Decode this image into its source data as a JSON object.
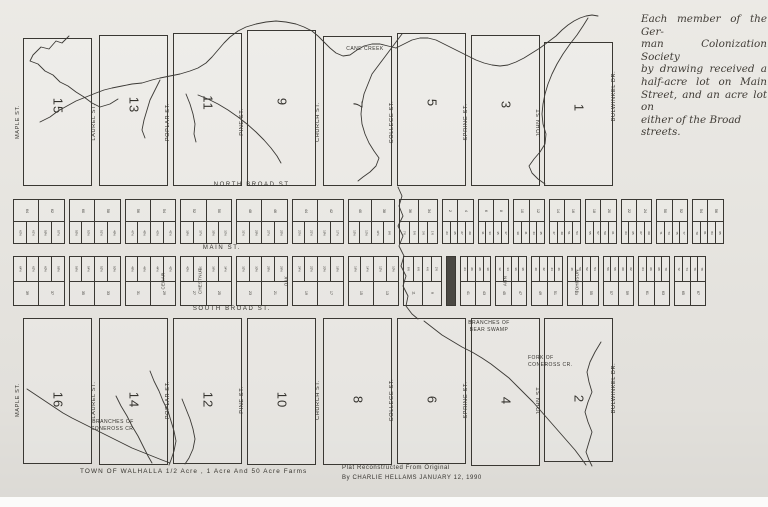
{
  "colors": {
    "paper": "#e9e7e2",
    "ink": "#35332e"
  },
  "streets": {
    "vertical": [
      "MAPLE ST.",
      "LAUREL ST.",
      "POPLAR ST.",
      "PINE ST.",
      "CHURCH ST.",
      "COLLEGE ST.",
      "SPRING ST.",
      "JOHN ST.",
      "BULWINKEL DR."
    ],
    "mid": [
      "CEDAR",
      "CHESTNUT",
      "OAK",
      "ANN",
      "JOHNSON"
    ],
    "north_broad": "NORTH BROAD ST.",
    "main": "MAIN ST.",
    "south_broad": "SOUTH BROAD ST."
  },
  "top_blocks": [
    "15",
    "13",
    "11",
    "9",
    "7",
    "5",
    "3",
    "1"
  ],
  "bottom_blocks": [
    "16",
    "14",
    "12",
    "10",
    "8",
    "6",
    "4",
    "2"
  ],
  "upper_strip": [
    {
      "broad": [
        "64",
        "62"
      ],
      "main": [
        "63½",
        "61½",
        "59½",
        "57½"
      ]
    },
    {
      "broad": [
        "60",
        "58"
      ],
      "main": [
        "55½",
        "53½",
        "51½",
        "49½"
      ]
    },
    {
      "broad": [
        "56",
        "54"
      ],
      "main": [
        "47½",
        "45½",
        "43½",
        "41½"
      ]
    },
    {
      "broad": [
        "52",
        "50"
      ],
      "main": [
        "39½",
        "37½",
        "35½",
        "33½"
      ]
    },
    {
      "broad": [
        "48",
        "46"
      ],
      "main": [
        "31½",
        "29½",
        "27½",
        "25½"
      ]
    },
    {
      "broad": [
        "44",
        "42"
      ],
      "main": [
        "23½",
        "21½",
        "19½",
        "17½"
      ]
    },
    {
      "broad": [
        "40",
        "38"
      ],
      "main": [
        "15½",
        "13½",
        "11½",
        "9½"
      ]
    },
    {
      "broad": [
        "36",
        "34"
      ],
      "main": [
        "7½",
        "5½",
        "3½",
        "1½"
      ]
    },
    {
      "broad": [
        "2",
        "4"
      ],
      "main": [
        "23",
        "25",
        "27",
        "29"
      ]
    },
    {
      "broad": [
        "6",
        "8"
      ],
      "main": [
        "31",
        "33",
        "35",
        "37"
      ]
    },
    {
      "broad": [
        "10",
        "12"
      ],
      "main": [
        "39",
        "41",
        "43",
        "45"
      ]
    },
    {
      "broad": [
        "14",
        "16"
      ],
      "main": [
        "47",
        "49",
        "51",
        "53"
      ]
    },
    {
      "broad": [
        "18",
        "20"
      ],
      "main": [
        "55",
        "57",
        "59",
        "61"
      ]
    },
    {
      "broad": [
        "22",
        "24"
      ],
      "main": [
        "63",
        "65",
        "67",
        "69"
      ]
    },
    {
      "broad": [
        "50",
        "52"
      ],
      "main": [
        "71",
        "73",
        "75",
        "77"
      ]
    },
    {
      "broad": [
        "54",
        "56"
      ],
      "main": [
        "79",
        "81",
        "83",
        "85"
      ]
    }
  ],
  "lower_strip": [
    {
      "main": [
        "64½",
        "62½",
        "60½",
        "58½"
      ],
      "broad": [
        "39",
        "37"
      ]
    },
    {
      "main": [
        "56½",
        "54½",
        "52½",
        "50½"
      ],
      "broad": [
        "35",
        "33"
      ]
    },
    {
      "main": [
        "48½",
        "46½",
        "44½",
        "42½"
      ],
      "broad": [
        "31",
        "29"
      ]
    },
    {
      "main": [
        "40½",
        "38½",
        "36½",
        "34½"
      ],
      "broad": [
        "27",
        "25"
      ]
    },
    {
      "main": [
        "32½",
        "30½",
        "28½",
        "26½"
      ],
      "broad": [
        "23",
        "21"
      ]
    },
    {
      "main": [
        "24½",
        "22½",
        "20½",
        "18½"
      ],
      "broad": [
        "19",
        "17"
      ]
    },
    {
      "main": [
        "16½",
        "14½",
        "12½",
        "10½"
      ],
      "broad": [
        "15",
        "13"
      ]
    },
    {
      "main": [
        "8½",
        "6½",
        "4½",
        "2½"
      ],
      "broad": [
        "11",
        "9"
      ]
    },
    {
      "dense": true,
      "grid": [
        [
          "1",
          "2",
          "3",
          "4"
        ],
        [
          "5",
          "6",
          "7",
          "8"
        ],
        [
          "9",
          "10",
          "11",
          "12"
        ],
        [
          "13",
          "14",
          "15",
          "16"
        ]
      ]
    },
    {
      "main": [
        "24",
        "26",
        "28",
        "30"
      ],
      "broad": [
        "41",
        "43"
      ]
    },
    {
      "main": [
        "32",
        "34",
        "36",
        "38"
      ],
      "broad": [
        "45",
        "47"
      ]
    },
    {
      "main": [
        "40",
        "42",
        "44",
        "46"
      ],
      "broad": [
        "49",
        "51"
      ]
    },
    {
      "main": [
        "48",
        "50",
        "52",
        "54"
      ],
      "broad": [
        "53",
        "55"
      ]
    },
    {
      "main": [
        "56",
        "58",
        "60",
        "62"
      ],
      "broad": [
        "57",
        "59"
      ]
    },
    {
      "main": [
        "64",
        "66",
        "68",
        "70"
      ],
      "broad": [
        "61",
        "63"
      ]
    },
    {
      "main": [
        "72",
        "74",
        "76",
        "78"
      ],
      "broad": [
        "65",
        "67"
      ]
    }
  ],
  "creeks": {
    "cane": "CANE CREEK",
    "bear": [
      "BRANCHES OF",
      "BEAR SWAMP"
    ],
    "fork": [
      "FORK OF",
      "CONEROSS CR."
    ],
    "coneross": [
      "BRANCHES OF",
      "CONEROSS CR."
    ]
  },
  "captions": {
    "town_title": "TOWN OF WALHALLA   1/2 Acre , 1 Acre And  50 Acre Farms",
    "credit1": "Plat  Reconstructed From Original",
    "credit2": "By CHARLIE HELLAMS   JANUARY 12, 1990"
  },
  "margin_note": [
    "Each member of the Ger-",
    "man Colonization Society",
    "by drawing received a",
    "half-acre lot on Main",
    "Street, and an acre lot on",
    "either of the Broad streets."
  ]
}
